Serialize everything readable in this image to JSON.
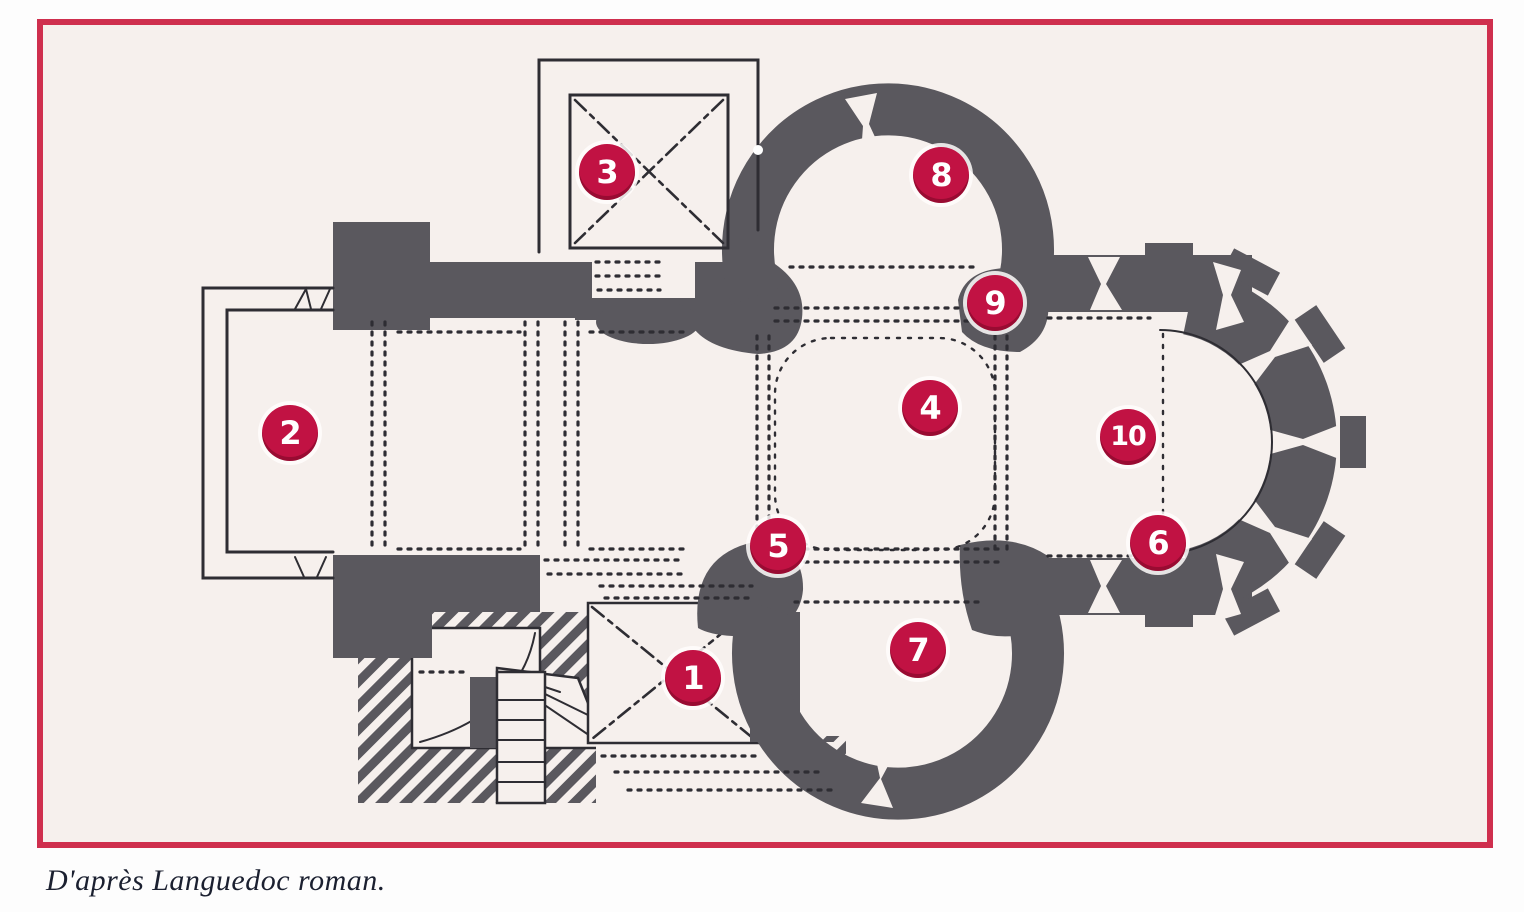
{
  "figure": {
    "type": "architectural-floor-plan",
    "subject": "Plan of a Romanesque church (Languedoc)",
    "caption": {
      "text": "D'après Languedoc roman."
    },
    "colors": {
      "frame": "#cf2f4e",
      "badge": "#c11243",
      "badge_text": "#ffffff",
      "wall": "#5a585e",
      "line": "#2e2d33",
      "paper": "#f6f0ed",
      "caption": "#1b2030"
    },
    "markers": [
      {
        "label": "1",
        "x": 693,
        "y": 678
      },
      {
        "label": "2",
        "x": 290,
        "y": 433
      },
      {
        "label": "3",
        "x": 607,
        "y": 172
      },
      {
        "label": "4",
        "x": 930,
        "y": 408
      },
      {
        "label": "5",
        "x": 778,
        "y": 546
      },
      {
        "label": "6",
        "x": 1158,
        "y": 543
      },
      {
        "label": "7",
        "x": 918,
        "y": 650
      },
      {
        "label": "8",
        "x": 941,
        "y": 175
      },
      {
        "label": "9",
        "x": 995,
        "y": 303
      },
      {
        "label": "10",
        "x": 1128,
        "y": 437
      }
    ]
  }
}
